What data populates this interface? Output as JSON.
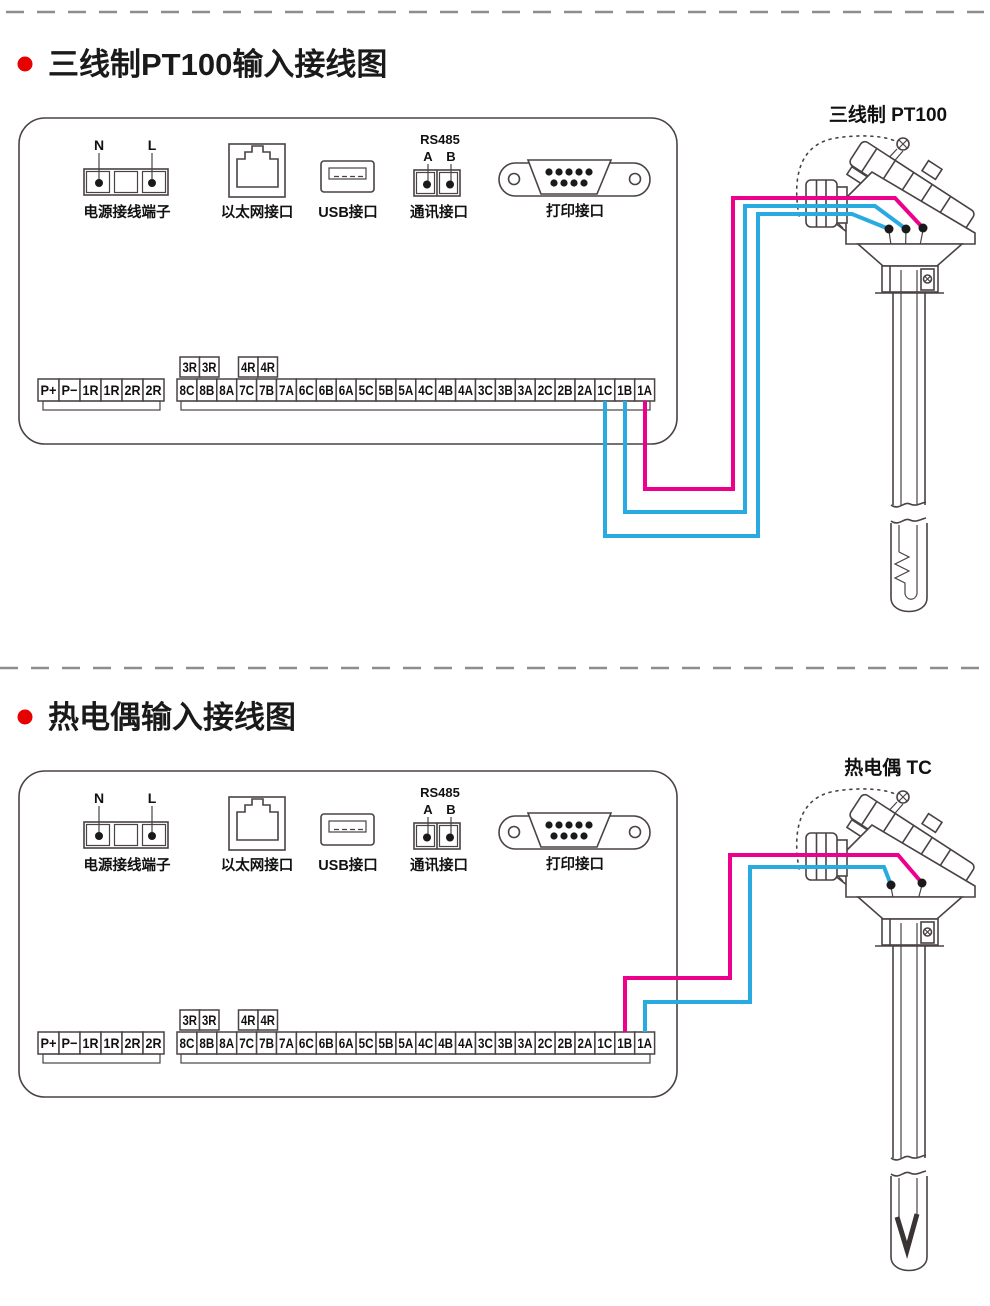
{
  "colors": {
    "wire_pink": "#ec008c",
    "wire_blue": "#29abe2",
    "bullet_red": "#e60000",
    "line": "#4a4244",
    "dash_gray": "#8d8d8d"
  },
  "sections": [
    {
      "title": "三线制PT100输入接线图",
      "sensor": {
        "label": "三线制 PT100",
        "type": "PT100"
      },
      "panel": {
        "connectors": {
          "power": {
            "pin_n": "N",
            "pin_l": "L",
            "label": "电源接线端子"
          },
          "ethernet": {
            "label": "以太网接口"
          },
          "usb": {
            "label": "USB接口"
          },
          "comm": {
            "protocol": "RS485",
            "pin_a": "A",
            "pin_b": "B",
            "label": "通讯接口"
          },
          "printer": {
            "label": "打印接口"
          }
        },
        "strip": {
          "left": [
            "P+",
            "P−",
            "1R",
            "1R",
            "2R",
            "2R"
          ],
          "aux1": [
            "3R",
            "3R"
          ],
          "aux2": [
            "4R",
            "4R"
          ],
          "main": [
            "8C",
            "8B",
            "8A",
            "7C",
            "7B",
            "7A",
            "6C",
            "6B",
            "6A",
            "5C",
            "5B",
            "5A",
            "4C",
            "4B",
            "4A",
            "3C",
            "3B",
            "3A",
            "2C",
            "2B",
            "2A",
            "1C",
            "1B",
            "1A"
          ]
        }
      },
      "wiring": [
        {
          "terminal": "1C",
          "wire": "blue"
        },
        {
          "terminal": "1B",
          "wire": "blue"
        },
        {
          "terminal": "1A",
          "wire": "pink"
        }
      ]
    },
    {
      "title": "热电偶输入接线图",
      "sensor": {
        "label": "热电偶 TC",
        "type": "TC"
      },
      "panel": {
        "connectors": {
          "power": {
            "pin_n": "N",
            "pin_l": "L",
            "label": "电源接线端子"
          },
          "ethernet": {
            "label": "以太网接口"
          },
          "usb": {
            "label": "USB接口"
          },
          "comm": {
            "protocol": "RS485",
            "pin_a": "A",
            "pin_b": "B",
            "label": "通讯接口"
          },
          "printer": {
            "label": "打印接口"
          }
        },
        "strip": {
          "left": [
            "P+",
            "P−",
            "1R",
            "1R",
            "2R",
            "2R"
          ],
          "aux1": [
            "3R",
            "3R"
          ],
          "aux2": [
            "4R",
            "4R"
          ],
          "main": [
            "8C",
            "8B",
            "8A",
            "7C",
            "7B",
            "7A",
            "6C",
            "6B",
            "6A",
            "5C",
            "5B",
            "5A",
            "4C",
            "4B",
            "4A",
            "3C",
            "3B",
            "3A",
            "2C",
            "2B",
            "2A",
            "1C",
            "1B",
            "1A"
          ]
        }
      },
      "wiring": [
        {
          "terminal": "1B",
          "wire": "pink"
        },
        {
          "terminal": "1A",
          "wire": "blue"
        }
      ]
    }
  ]
}
